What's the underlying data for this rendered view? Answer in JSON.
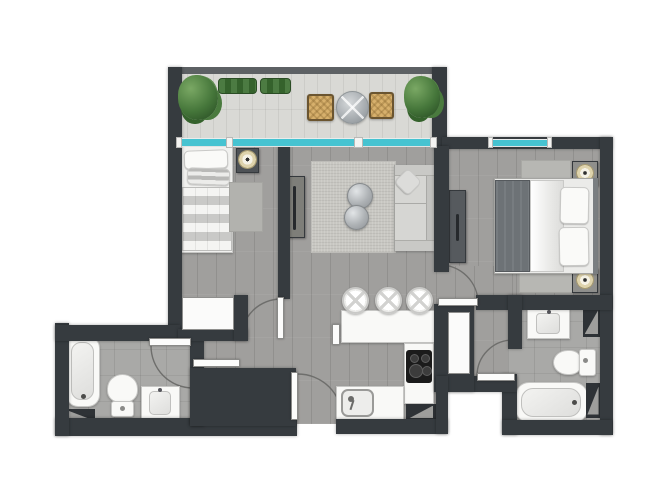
{
  "plan": {
    "title": "apartment-floor-plan-render",
    "style": "top-down 2D architectural render, no text labels visible",
    "colors": {
      "wall": "#363b3f",
      "balcony_rail": "#5d6164",
      "window_glass": "#46c3d1",
      "floor_main": "#a09f9d",
      "floor_bathroom": "#a9a9a7",
      "floor_balcony": "#d9d9d5",
      "fixture_white": "#f9f9f7",
      "plant_green": "#45763a",
      "wicker_tan": "#d7b06c",
      "dark_cabinet": "#565a5e"
    },
    "rooms": [
      {
        "name": "balcony",
        "furniture": [
          "potted-plant",
          "hedge-planter",
          "hedge-planter",
          "round-bistro-table",
          "wicker-chair-left",
          "wicker-chair-right",
          "potted-plant"
        ]
      },
      {
        "name": "bedroom-1",
        "furniture": [
          "single-bed",
          "nightstand-with-lamp",
          "rug",
          "built-in-closet"
        ]
      },
      {
        "name": "living-room",
        "furniture": [
          "sideboard",
          "area-rug",
          "nesting-coffee-tables",
          "sofa-with-throw-pillow"
        ]
      },
      {
        "name": "kitchen",
        "furniture": [
          "breakfast-bar",
          "bar-stool",
          "bar-stool",
          "bar-stool",
          "cooktop-4-burner",
          "kitchen-sink",
          "service-shaft"
        ]
      },
      {
        "name": "bedroom-2",
        "furniture": [
          "double-bed",
          "nightstand-with-lamp",
          "nightstand-with-lamp",
          "runner-rug",
          "runner-rug",
          "wardrobe"
        ]
      },
      {
        "name": "bathroom-1",
        "furniture": [
          "bathtub",
          "toilet",
          "vanity-sink",
          "service-shaft"
        ]
      },
      {
        "name": "laundry-niche",
        "furniture": [
          "service-shaft",
          "washing-machine",
          "steel-cabinet"
        ]
      },
      {
        "name": "hall-corridor",
        "furniture": [
          "hall-closet"
        ]
      },
      {
        "name": "bathroom-2",
        "furniture": [
          "vanity-sink",
          "toilet",
          "bathtub",
          "service-shaft",
          "service-shaft"
        ]
      }
    ],
    "doors": [
      {
        "name": "bathroom-1-door",
        "type": "swing"
      },
      {
        "name": "bedroom-1-door",
        "type": "swing"
      },
      {
        "name": "laundry-door",
        "type": "leaf"
      },
      {
        "name": "entrance-door",
        "type": "swing"
      },
      {
        "name": "bedroom-2-door",
        "type": "swing"
      },
      {
        "name": "bathroom-2-door",
        "type": "swing"
      }
    ],
    "windows": [
      {
        "name": "balcony-sliding-glazing",
        "location": "between balcony and living/bedroom-1"
      },
      {
        "name": "bedroom-2-window",
        "location": "bedroom-2 top wall"
      }
    ]
  }
}
